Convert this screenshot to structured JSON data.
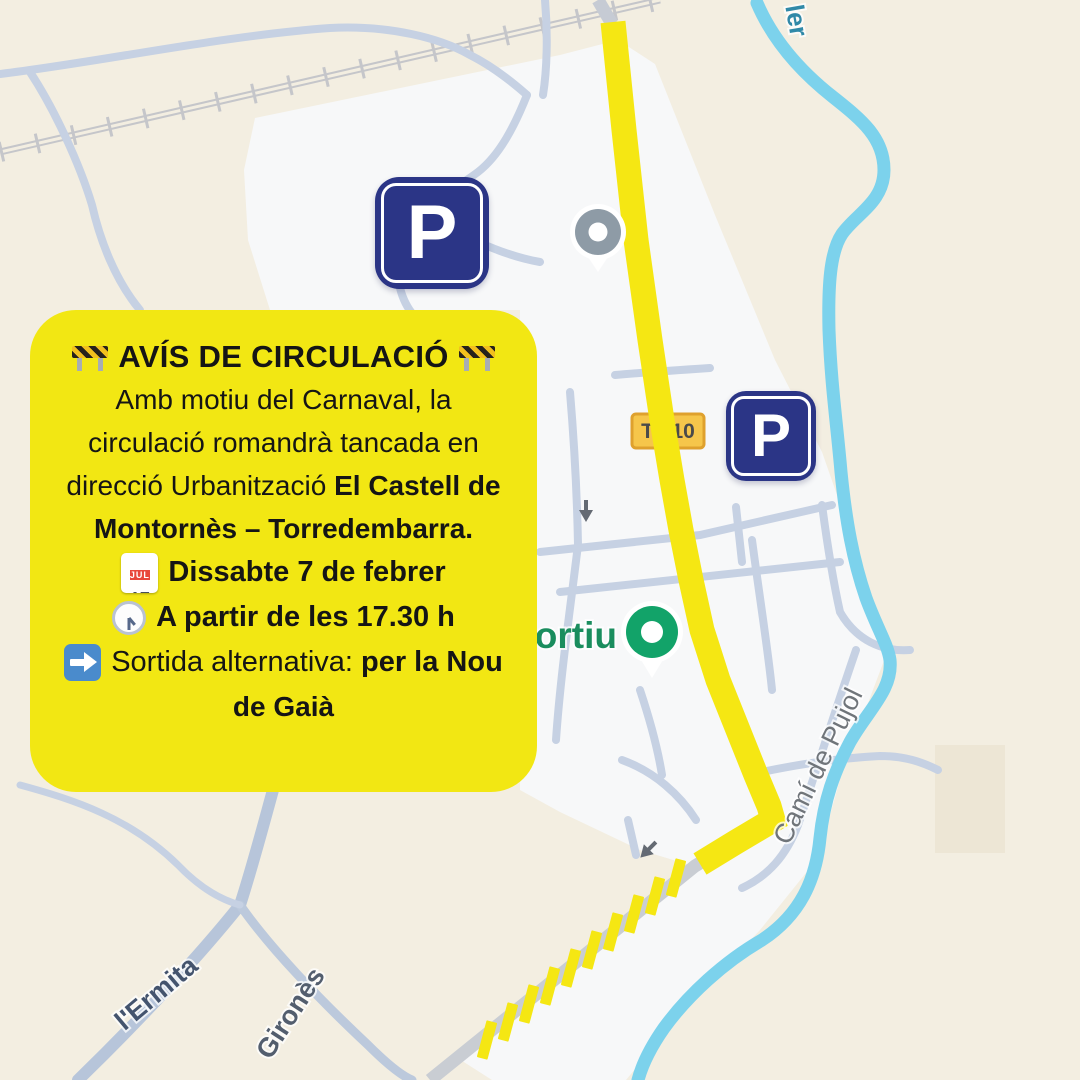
{
  "notice": {
    "title": "AVÍS DE CIRCULACIÓ",
    "body_line1": "Amb motiu del Carnaval, la",
    "body_line2": "circulació romandrà tancada en",
    "body_line3_regular": "direcció Urbanització",
    "body_line3_bold": "El Castell de",
    "body_line4_bold": "Montornès – Torredembarra.",
    "calendar": {
      "month": "JUL",
      "day": "17"
    },
    "date_text": "Dissabte 7 de febrer",
    "time_text": "A partir de les 17.30 h",
    "alternative_regular": "Sortida alternativa:",
    "alternative_bold_line1": "per la Nou",
    "alternative_bold_line2": "de Gaià",
    "background_color": "#F2E713",
    "text_color": "#151515"
  },
  "map": {
    "road_shield": "T-210",
    "parking_sign": "P",
    "labels": {
      "poi_sports": "portiu",
      "street_pujol": "Camí de Pujol",
      "street_ermita": "l'Ermita",
      "street_girones": "Gironès",
      "water": "ler"
    },
    "colors": {
      "land": "#F3EEE1",
      "urban": "#F7F8F9",
      "water": "#7CD2EC",
      "route_yellow": "#F5E713",
      "minor_road": "#C6D1E3",
      "main_road": "#C9CDD3",
      "parking_blue": "#2B3586",
      "poi_green": "#12A369",
      "poi_text_green": "#1A8D5E",
      "pin_gray": "#8E9BA6",
      "shield_fill": "#F6C64B"
    }
  }
}
